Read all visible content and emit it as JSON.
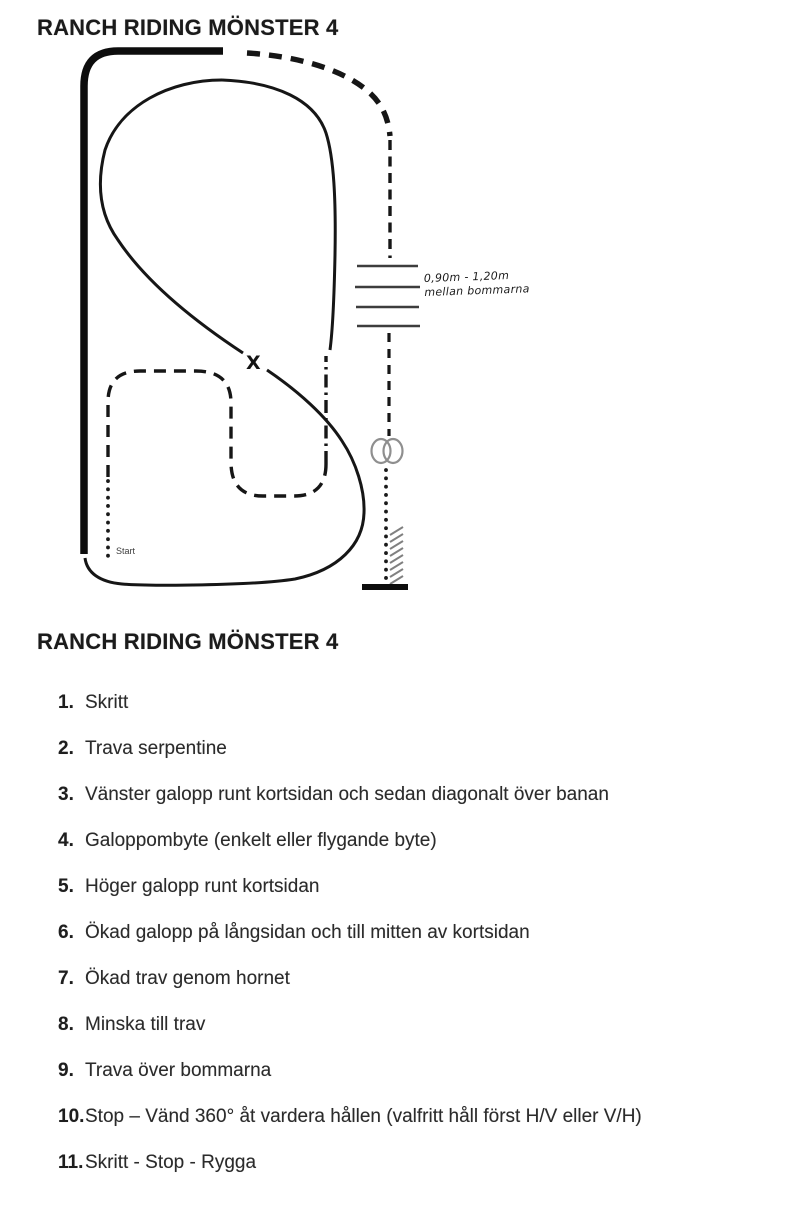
{
  "page": {
    "title_top": "RANCH RIDING MÖNSTER 4",
    "title_list": "RANCH RIDING MÖNSTER 4",
    "background": "#ffffff"
  },
  "diagram": {
    "lead_change_marker": "X",
    "start_label": "Start",
    "poles_note": {
      "line1": "0,90m - 1,20m",
      "line2": "mellan bommarna"
    },
    "pole_count": 4,
    "colors": {
      "ink": "#161616",
      "thick_line": "#0d0d0d",
      "poles": "#3d3d3d",
      "turn_symbol": "#8f8f8f",
      "hatch": "#808080",
      "note_text": "#1b1b1b",
      "start_text": "#3c3c3c"
    }
  },
  "steps": {
    "items": [
      {
        "num": "1.",
        "text": "Skritt"
      },
      {
        "num": "2.",
        "text": "Trava serpentine"
      },
      {
        "num": "3.",
        "text": "Vänster galopp runt kortsidan och sedan diagonalt över banan"
      },
      {
        "num": "4.",
        "text": "Galoppombyte (enkelt eller flygande byte)"
      },
      {
        "num": "5.",
        "text": "Höger galopp runt kortsidan"
      },
      {
        "num": "6.",
        "text": "Ökad galopp på långsidan och till mitten av kortsidan"
      },
      {
        "num": "7.",
        "text": "Ökad trav genom hornet"
      },
      {
        "num": "8.",
        "text": "Minska till trav"
      },
      {
        "num": "9.",
        "text": "Trava över bommarna"
      },
      {
        "num": "10.",
        "text": "Stop – Vänd 360° åt vardera hållen (valfritt håll först H/V eller V/H)"
      },
      {
        "num": "11.",
        "text": "Skritt - Stop - Rygga"
      }
    ]
  }
}
